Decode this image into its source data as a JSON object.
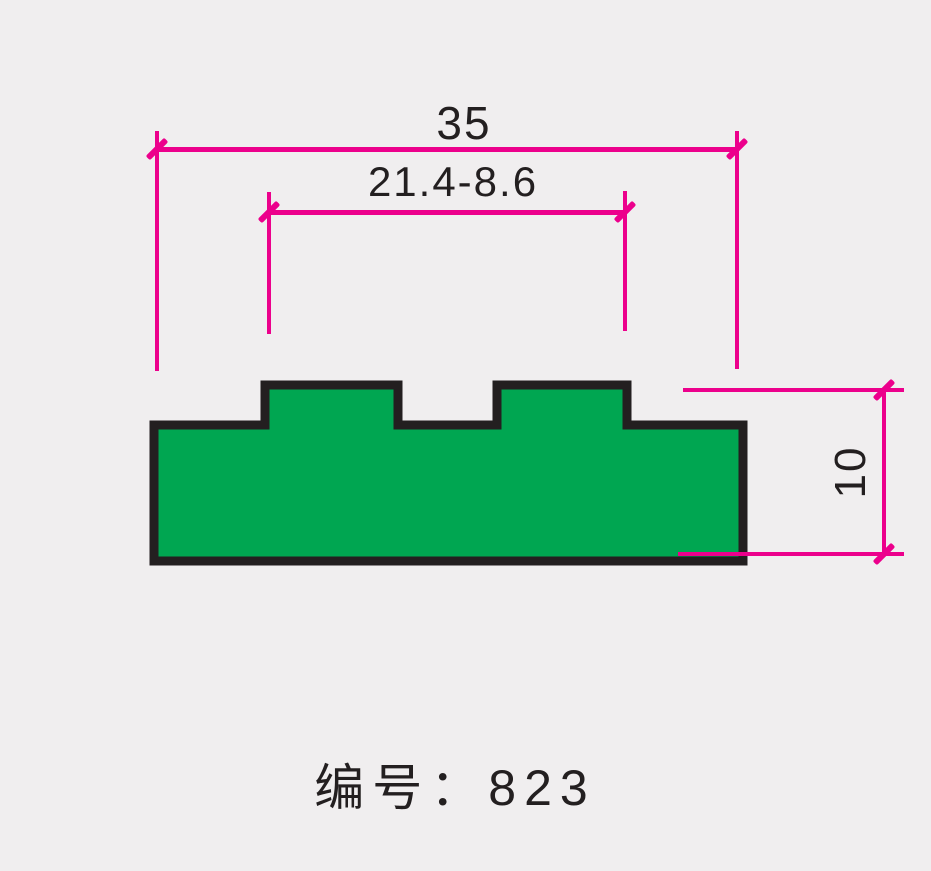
{
  "page": {
    "background": "#F0EEEF"
  },
  "drawing": {
    "type": "profile-cross-section",
    "colors": {
      "profile_fill": "#00A651",
      "profile_outline": "#231F20",
      "dimension_lines": "#EC008C",
      "text": "#231F20"
    },
    "dimensions": {
      "overall_width": {
        "label": "35",
        "value": 35
      },
      "tab_span": {
        "label": "21.4-8.6"
      },
      "height": {
        "label": "10",
        "value": 10
      }
    },
    "caption": {
      "label": "编号：823",
      "number": "823"
    }
  }
}
